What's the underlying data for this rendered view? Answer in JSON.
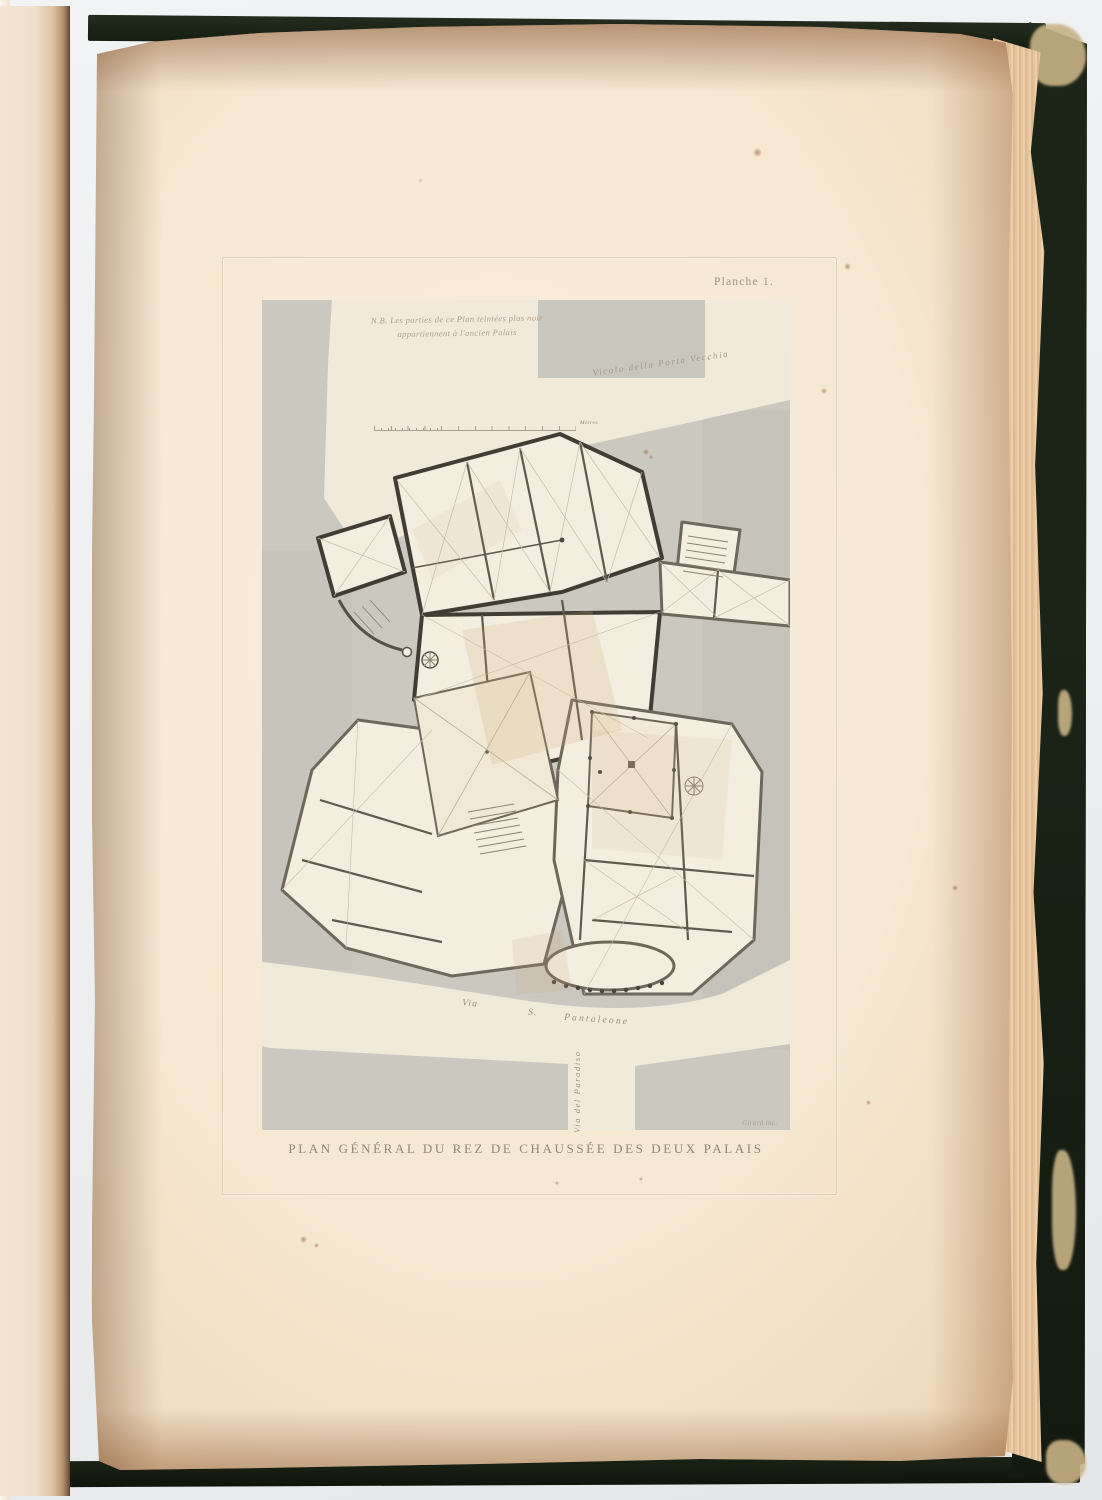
{
  "plate": {
    "plate_number": "Planche 1.",
    "note": {
      "line1": "N.B. Les parties de ce Plan teintées plus noir",
      "line2": "appartiennent à l'ancien Palais"
    },
    "streets": {
      "vicolo": "Vicolo della Porta Vecchia",
      "via": "Via",
      "s": "S.",
      "pantaleone": "Pantaleone",
      "paradiso": "Via del Paradiso"
    },
    "scale_label": "Mètres",
    "caption": "PLAN GÉNÉRAL DU REZ DE CHAUSSÉE DES DEUX PALAIS",
    "engraver_signature": "Girard inc."
  },
  "colors": {
    "cover_green": "#1b2417",
    "page_cream": "#f6e8d3",
    "plate_gray": "#cbc8bf",
    "plan_paper": "#f5efe1",
    "wall_ancient": "#413d35",
    "wall_modern": "#6e675b",
    "label_ink": "#9a8b76"
  }
}
